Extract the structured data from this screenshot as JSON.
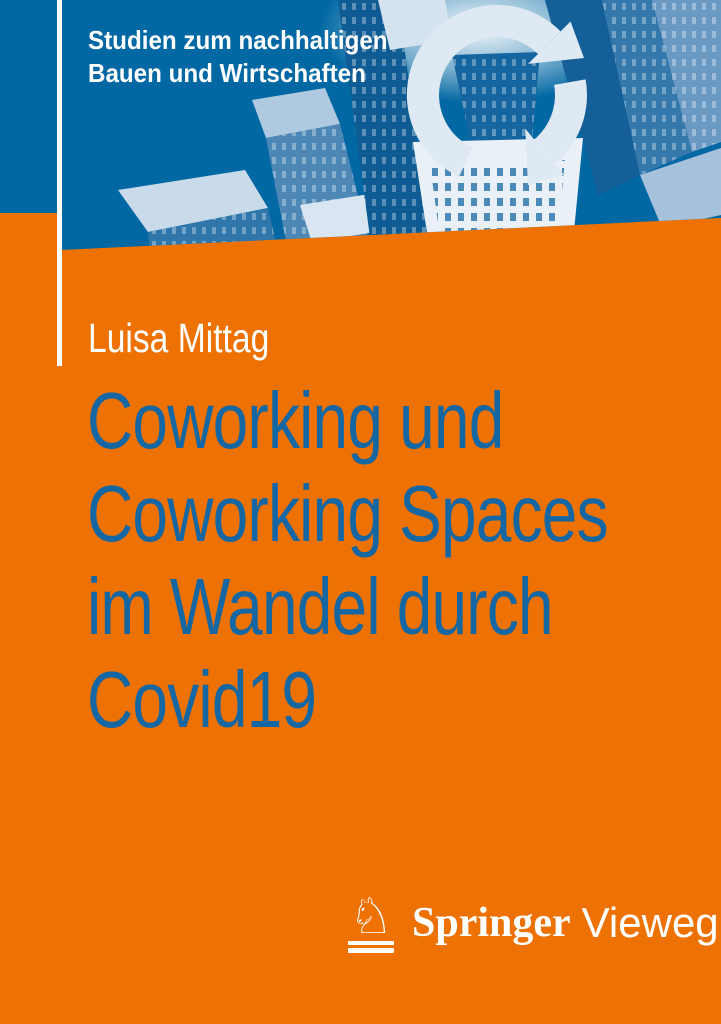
{
  "series": {
    "lines": [
      "Studien zum nachhaltigen",
      "Bauen und Wirtschaften"
    ]
  },
  "author": "Luisa Mittag",
  "title": {
    "lines": [
      "Coworking und",
      "Coworking Spaces",
      "im Wandel durch",
      "Covid19"
    ]
  },
  "publisher": {
    "name_serif": "Springer",
    "name_sans": "Vieweg",
    "logo_icon": "springer-horse-icon",
    "logo_glyph": "♘"
  },
  "artwork": {
    "scene": "aerial-cityscape-with-circular-arrows",
    "icon": "circular-arrows-icon"
  },
  "colors": {
    "cover_orange": "#ED7103",
    "header_blue": "#0268A4",
    "title_blue": "#1467A3",
    "text_white": "#FFFFFF"
  }
}
